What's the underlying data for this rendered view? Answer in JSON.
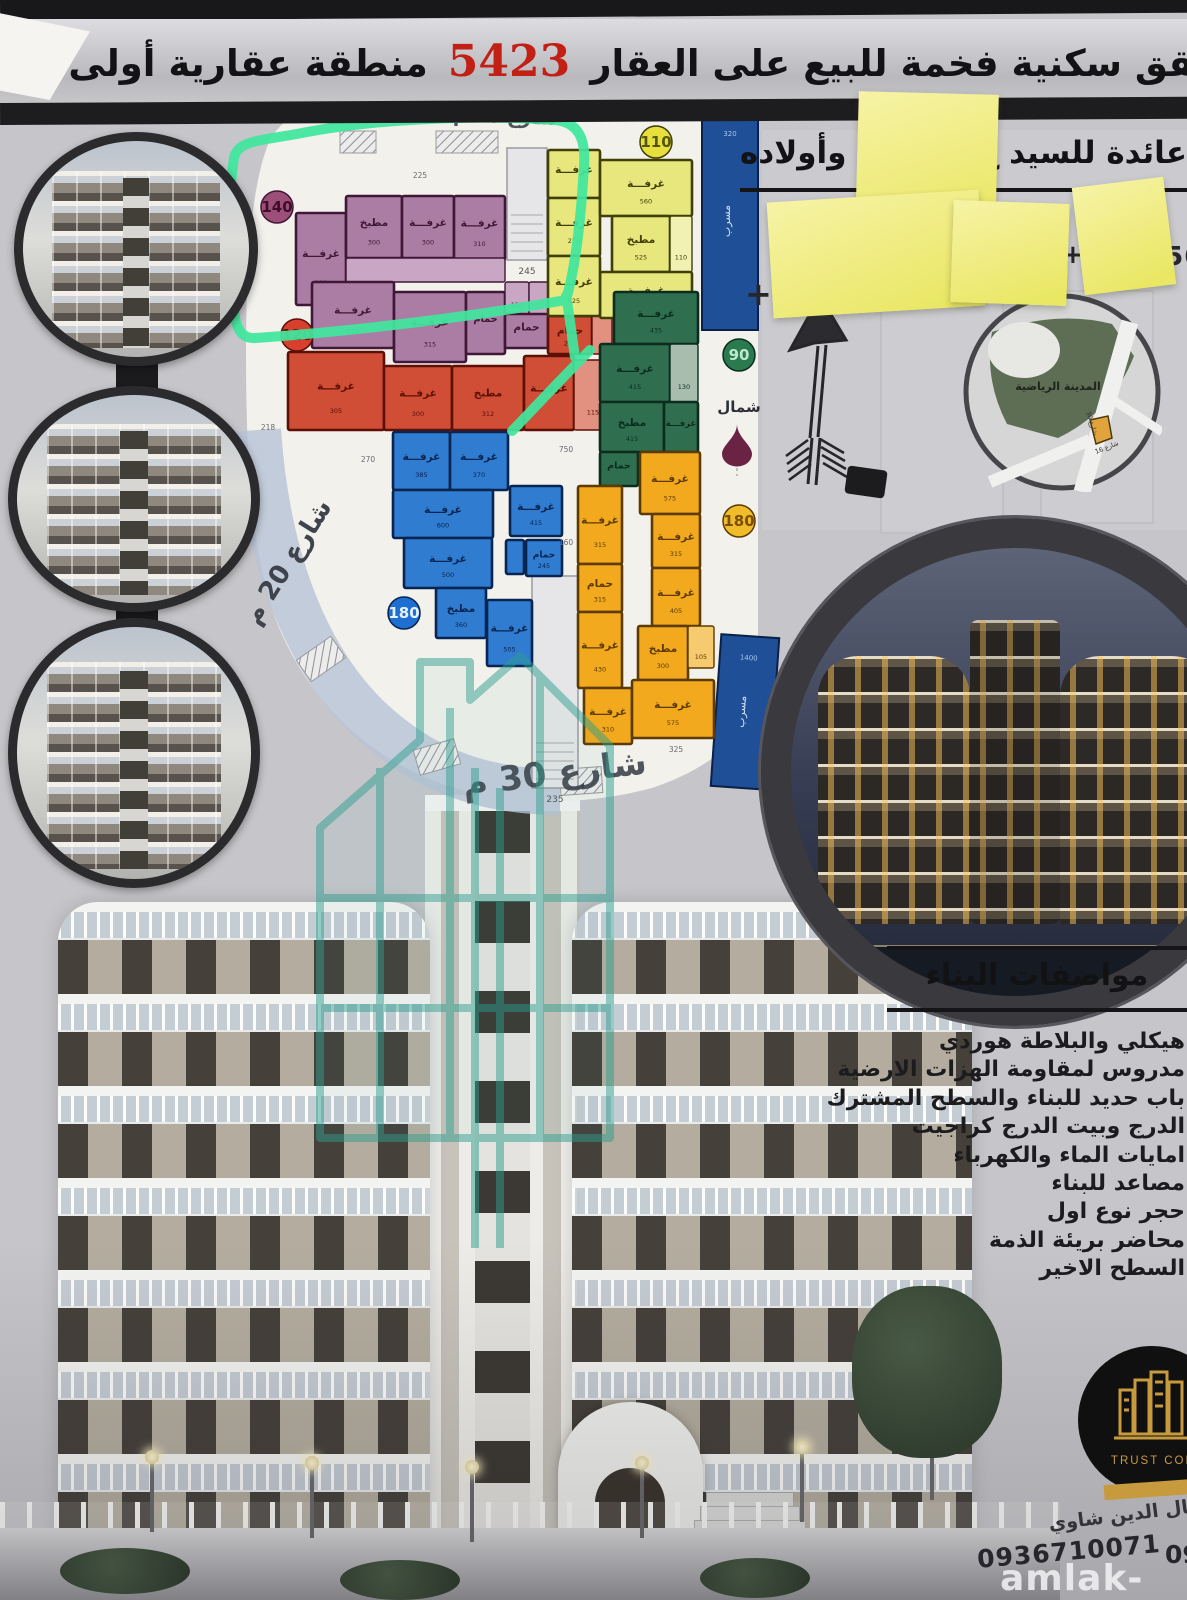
{
  "title": {
    "text": "شقق سكنية فخمة للبيع على العقار",
    "number": "5423",
    "location": "منطقة عقارية أولى بادلب"
  },
  "ownership": {
    "prefix": "عائدة للسيد ع",
    "suffix": "وأولاده",
    "phone_fragments": {
      "left": "+",
      "mid": "+9",
      "right": "5565"
    }
  },
  "floor_plan": {
    "street_top": "شارع 16 م",
    "street_left": "شارع 20 م",
    "street_bottom": "شارع 30 م",
    "north_label": "شمال",
    "stair_cores": [
      {
        "x": 507,
        "y": 148,
        "w": 40,
        "h": 112,
        "num": "245"
      },
      {
        "x": 532,
        "y": 576,
        "w": 46,
        "h": 212,
        "num": "235"
      }
    ],
    "corridors": [
      {
        "x": 702,
        "y": 112,
        "w": 56,
        "h": 218,
        "label": "مسرب",
        "num": "320",
        "rot": 0
      },
      {
        "x": 716,
        "y": 636,
        "w": 58,
        "h": 152,
        "label": "مسرب",
        "num": "1400",
        "rot": 4
      }
    ],
    "stray_dims": [
      {
        "t": "750",
        "x": 566,
        "y": 452
      },
      {
        "t": "270",
        "x": 368,
        "y": 462
      },
      {
        "t": "160",
        "x": 566,
        "y": 545
      },
      {
        "t": "325",
        "x": 676,
        "y": 752
      },
      {
        "t": "218",
        "x": 268,
        "y": 430
      },
      {
        "t": "225",
        "x": 420,
        "y": 178
      }
    ],
    "apartments": [
      {
        "name": "purple",
        "badge": "140",
        "badge_x": 277,
        "badge_y": 207,
        "badge_bg": "#9c4f79",
        "badge_fg": "#3c0e2a",
        "fill": "#ab7da5",
        "light": "#c9a6c3",
        "stroke": "#401737",
        "rooms": [
          {
            "x": 296,
            "y": 213,
            "w": 50,
            "h": 92,
            "l": "غرفـــة",
            "n": "160"
          },
          {
            "x": 346,
            "y": 196,
            "w": 56,
            "h": 62,
            "l": "مطبخ",
            "n": "300"
          },
          {
            "x": 402,
            "y": 196,
            "w": 52,
            "h": 62,
            "l": "غرفـــة",
            "n": "300"
          },
          {
            "x": 454,
            "y": 196,
            "w": 51,
            "h": 64,
            "l": "غرفـــة",
            "n": "310"
          },
          {
            "x": 346,
            "y": 258,
            "w": 159,
            "h": 24,
            "l": "",
            "n": "",
            "c": true
          },
          {
            "x": 312,
            "y": 282,
            "w": 82,
            "h": 66,
            "l": "غرفـــة",
            "n": "525"
          },
          {
            "x": 394,
            "y": 292,
            "w": 72,
            "h": 70,
            "l": "غرفـــة",
            "n": "315"
          },
          {
            "x": 466,
            "y": 292,
            "w": 39,
            "h": 62,
            "l": "حمام",
            "n": ""
          },
          {
            "x": 505,
            "y": 282,
            "w": 24,
            "h": 32,
            "l": "",
            "n": "110",
            "c": true
          },
          {
            "x": 529,
            "y": 282,
            "w": 19,
            "h": 32,
            "l": "",
            "n": "",
            "c": true
          },
          {
            "x": 505,
            "y": 314,
            "w": 43,
            "h": 34,
            "l": "حمام",
            "n": ""
          }
        ]
      },
      {
        "name": "red",
        "badge": "120",
        "badge_x": 297,
        "badge_y": 335,
        "badge_bg": "#d8402e",
        "badge_fg": "#5c0e06",
        "fill": "#cf4e35",
        "light": "#e2907f",
        "stroke": "#5e0f06",
        "rooms": [
          {
            "x": 288,
            "y": 352,
            "w": 96,
            "h": 78,
            "l": "غرفـــة",
            "n": "305"
          },
          {
            "x": 384,
            "y": 366,
            "w": 68,
            "h": 64,
            "l": "غرفـــة",
            "n": "300"
          },
          {
            "x": 452,
            "y": 366,
            "w": 72,
            "h": 64,
            "l": "مطبخ",
            "n": "312"
          },
          {
            "x": 524,
            "y": 356,
            "w": 50,
            "h": 74,
            "l": "غرفـــة",
            "n": ""
          },
          {
            "x": 548,
            "y": 316,
            "w": 44,
            "h": 38,
            "l": "حمام",
            "n": "260"
          },
          {
            "x": 592,
            "y": 292,
            "w": 20,
            "h": 62,
            "l": "",
            "n": "",
            "c": true
          },
          {
            "x": 574,
            "y": 360,
            "w": 38,
            "h": 70,
            "l": "",
            "n": "115",
            "c": true
          }
        ]
      },
      {
        "name": "yellow",
        "badge": "110",
        "badge_x": 656,
        "badge_y": 142,
        "badge_bg": "#e6df3e",
        "badge_fg": "#55550d",
        "fill": "#e7e77e",
        "light": "#f1f1b4",
        "stroke": "#3f3f06",
        "rooms": [
          {
            "x": 548,
            "y": 150,
            "w": 52,
            "h": 48,
            "l": "غرفـــة",
            "n": ""
          },
          {
            "x": 548,
            "y": 198,
            "w": 52,
            "h": 58,
            "l": "غرفـــة",
            "n": "270"
          },
          {
            "x": 600,
            "y": 160,
            "w": 92,
            "h": 56,
            "l": "غرفـــة",
            "n": "560"
          },
          {
            "x": 612,
            "y": 216,
            "w": 58,
            "h": 56,
            "l": "مطبخ",
            "n": "525"
          },
          {
            "x": 670,
            "y": 216,
            "w": 22,
            "h": 56,
            "l": "",
            "n": "110",
            "c": true
          },
          {
            "x": 600,
            "y": 272,
            "w": 92,
            "h": 46,
            "l": "غرفـــة",
            "n": "435"
          },
          {
            "x": 548,
            "y": 256,
            "w": 52,
            "h": 60,
            "l": "غرفـــة",
            "n": "525"
          }
        ]
      },
      {
        "name": "green",
        "badge": "90",
        "badge_x": 739,
        "badge_y": 355,
        "badge_bg": "#2a7a50",
        "badge_fg": "#bfe9cd",
        "fill": "#2f6f50",
        "light": "#a9bdae",
        "stroke": "#0c2d1e",
        "rooms": [
          {
            "x": 614,
            "y": 292,
            "w": 84,
            "h": 52,
            "l": "غرفـــة",
            "n": "435"
          },
          {
            "x": 600,
            "y": 344,
            "w": 70,
            "h": 58,
            "l": "غرفـــة",
            "n": "415"
          },
          {
            "x": 670,
            "y": 344,
            "w": 28,
            "h": 58,
            "l": "",
            "n": "130",
            "c": true
          },
          {
            "x": 600,
            "y": 402,
            "w": 64,
            "h": 50,
            "l": "مطبخ",
            "n": "415"
          },
          {
            "x": 664,
            "y": 402,
            "w": 34,
            "h": 50,
            "l": "غرفـــة",
            "n": ""
          },
          {
            "x": 600,
            "y": 452,
            "w": 38,
            "h": 34,
            "l": "حمام",
            "n": ""
          }
        ]
      },
      {
        "name": "blue",
        "badge": "180",
        "badge_x": 404,
        "badge_y": 613,
        "badge_bg": "#1e6fd2",
        "badge_fg": "#e8f2ff",
        "fill": "#2f7cd0",
        "light": "#8abbec",
        "stroke": "#082552",
        "rooms": [
          {
            "x": 393,
            "y": 432,
            "w": 57,
            "h": 58,
            "l": "غرفـــة",
            "n": "385"
          },
          {
            "x": 450,
            "y": 432,
            "w": 58,
            "h": 58,
            "l": "غرفـــة",
            "n": "370"
          },
          {
            "x": 393,
            "y": 490,
            "w": 100,
            "h": 48,
            "l": "غرفـــة",
            "n": "600"
          },
          {
            "x": 404,
            "y": 538,
            "w": 88,
            "h": 50,
            "l": "غرفـــة",
            "n": "500"
          },
          {
            "x": 436,
            "y": 588,
            "w": 50,
            "h": 50,
            "l": "مطبخ",
            "n": "360"
          },
          {
            "x": 487,
            "y": 600,
            "w": 45,
            "h": 66,
            "l": "غرفـــة",
            "n": "505"
          },
          {
            "x": 510,
            "y": 486,
            "w": 52,
            "h": 50,
            "l": "غرفـــة",
            "n": "415"
          },
          {
            "x": 506,
            "y": 540,
            "w": 18,
            "h": 34,
            "l": "",
            "n": ""
          },
          {
            "x": 526,
            "y": 540,
            "w": 36,
            "h": 36,
            "l": "حمام",
            "n": "245"
          }
        ]
      },
      {
        "name": "amber",
        "badge": "180",
        "badge_x": 739,
        "badge_y": 521,
        "badge_bg": "#f0bc2a",
        "badge_fg": "#7a4d08",
        "fill": "#f2a91e",
        "light": "#f6ca6e",
        "stroke": "#5c3a02",
        "rooms": [
          {
            "x": 640,
            "y": 452,
            "w": 60,
            "h": 62,
            "l": "غرفـــة",
            "n": "575"
          },
          {
            "x": 578,
            "y": 486,
            "w": 44,
            "h": 78,
            "l": "غرفـــة",
            "n": "315"
          },
          {
            "x": 652,
            "y": 514,
            "w": 48,
            "h": 54,
            "l": "غرفـــة",
            "n": "315"
          },
          {
            "x": 652,
            "y": 568,
            "w": 48,
            "h": 58,
            "l": "غرفـــة",
            "n": "405"
          },
          {
            "x": 578,
            "y": 564,
            "w": 44,
            "h": 48,
            "l": "حمام",
            "n": "315"
          },
          {
            "x": 578,
            "y": 612,
            "w": 44,
            "h": 76,
            "l": "غرفـــة",
            "n": "430"
          },
          {
            "x": 638,
            "y": 626,
            "w": 50,
            "h": 54,
            "l": "مطبخ",
            "n": "300"
          },
          {
            "x": 688,
            "y": 626,
            "w": 26,
            "h": 42,
            "l": "",
            "n": "105",
            "c": true
          },
          {
            "x": 584,
            "y": 688,
            "w": 48,
            "h": 56,
            "l": "غرفـــة",
            "n": "310"
          },
          {
            "x": 632,
            "y": 680,
            "w": 82,
            "h": 58,
            "l": "غرفـــة",
            "n": "575"
          }
        ]
      }
    ]
  },
  "map_inset": {
    "park_label": "المدينة الرياضية",
    "street_a": "شارع 30",
    "street_b": "شارع 16"
  },
  "specs": {
    "heading": "مواصفات البناء",
    "items": [
      "هيكلي والبلاطة هوردي",
      "مدروس لمقاومة الهزات الارضية",
      "باب حديد للبناء والسطح المشترك",
      "الدرج وبيت الدرج كراجيت",
      "امايات الماء والكهرباء",
      "مصاعد للبناء",
      "حجر نوع اول",
      "محاضر بريئة الذمة",
      "السطح الاخير"
    ]
  },
  "contact": {
    "name": "كمال الدين شاوي",
    "phone": "0936710071",
    "phone2_fragment": "09",
    "logo_text": "TRUST COM",
    "watermark": "amlak-sy.com"
  },
  "colors": {
    "accent_red": "#c21f15",
    "marker_green": "#41e69e",
    "note_yellow": "#f0ec8f"
  }
}
